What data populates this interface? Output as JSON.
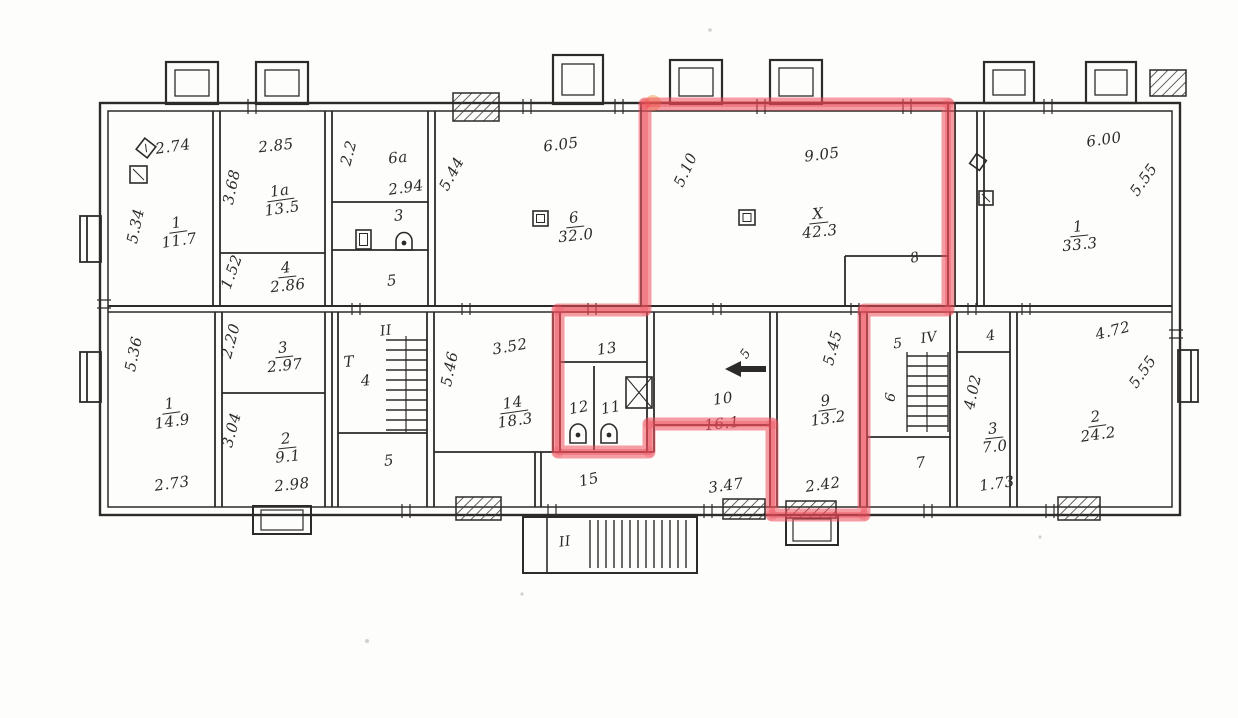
{
  "scan": {
    "paper_color": "#fdfdfc",
    "ink_color": "#2d2b2a",
    "marker_color": "#ee4e5a",
    "icon_legend": [
      "flue-icon",
      "toilet-icon",
      "sink-icon",
      "vent-shaft-icon",
      "direction-arrow-icon",
      "stairs-icon",
      "chimney-icon",
      "hatched-shaft-icon"
    ],
    "highlight": {
      "points": "645,104 948,104 948,310 864,310 864,515 772,515 772,424 649,424 649,452 558,452 558,310 645,310 645,104"
    },
    "labels": [
      {
        "name": "dim-room1-top",
        "kind": "dim",
        "text": "2.74",
        "x": 173,
        "y": 147,
        "rot": -8
      },
      {
        "name": "dim-room1-left",
        "kind": "dim",
        "text": "5.34",
        "x": 136,
        "y": 226,
        "rot": -78
      },
      {
        "name": "room1-upper",
        "kind": "frac",
        "num": "1",
        "den": "11.7",
        "x": 178,
        "y": 232,
        "rot": -8
      },
      {
        "name": "dim-room1a-top",
        "kind": "dim",
        "text": "2.85",
        "x": 276,
        "y": 146,
        "rot": -6
      },
      {
        "name": "dim-room1a-left",
        "kind": "dim",
        "text": "3.68",
        "x": 232,
        "y": 187,
        "rot": -78
      },
      {
        "name": "room1a",
        "kind": "frac",
        "num": "1а",
        "den": "13.5",
        "x": 281,
        "y": 200,
        "rot": -8
      },
      {
        "name": "dim-room4-left",
        "kind": "dim",
        "text": "1.52",
        "x": 232,
        "y": 272,
        "rot": -70
      },
      {
        "name": "room4",
        "kind": "frac",
        "num": "4",
        "den": "2.86",
        "x": 287,
        "y": 277,
        "rot": -6
      },
      {
        "name": "dim-room6a-left",
        "kind": "dim",
        "text": "2.2",
        "x": 349,
        "y": 153,
        "rot": -75
      },
      {
        "name": "room6a",
        "kind": "txt",
        "text": "6а",
        "x": 398,
        "y": 158,
        "rot": -6
      },
      {
        "name": "dim-room6a",
        "kind": "dim",
        "text": "2.94",
        "x": 406,
        "y": 188,
        "rot": -8
      },
      {
        "name": "room3-upper",
        "kind": "txt",
        "text": "3",
        "x": 399,
        "y": 216,
        "rot": -5
      },
      {
        "name": "room5-upper",
        "kind": "txt",
        "text": "5",
        "x": 392,
        "y": 281,
        "rot": -5
      },
      {
        "name": "dim-room6-top",
        "kind": "dim",
        "text": "6.05",
        "x": 561,
        "y": 145,
        "rot": -7
      },
      {
        "name": "dim-room6-left",
        "kind": "dim",
        "text": "5.44",
        "x": 452,
        "y": 174,
        "rot": -62
      },
      {
        "name": "room6",
        "kind": "frac",
        "num": "6",
        "den": "32.0",
        "x": 575,
        "y": 227,
        "rot": -6
      },
      {
        "name": "dim-roomx-top",
        "kind": "dim",
        "text": "9.05",
        "x": 822,
        "y": 155,
        "rot": -7
      },
      {
        "name": "dim-roomx-left",
        "kind": "dim",
        "text": "5.10",
        "x": 686,
        "y": 170,
        "rot": -65
      },
      {
        "name": "roomx",
        "kind": "frac",
        "num": "Х",
        "den": "42.3",
        "x": 819,
        "y": 223,
        "rot": -6
      },
      {
        "name": "room8",
        "kind": "txt",
        "text": "8",
        "x": 915,
        "y": 258,
        "rot": -12,
        "size": 14
      },
      {
        "name": "dim-room1r-top",
        "kind": "dim",
        "text": "6.00",
        "x": 1104,
        "y": 140,
        "rot": -8
      },
      {
        "name": "dim-room1r-right",
        "kind": "dim",
        "text": "5.55",
        "x": 1144,
        "y": 180,
        "rot": -55
      },
      {
        "name": "room1-right",
        "kind": "frac",
        "num": "1",
        "den": "33.3",
        "x": 1079,
        "y": 236,
        "rot": -6
      },
      {
        "name": "dim-room1b-left",
        "kind": "dim",
        "text": "5.36",
        "x": 134,
        "y": 354,
        "rot": -78
      },
      {
        "name": "room1-lower",
        "kind": "frac",
        "num": "1",
        "den": "14.9",
        "x": 171,
        "y": 413,
        "rot": -8
      },
      {
        "name": "dim-room1b-bottom",
        "kind": "dim",
        "text": "2.73",
        "x": 172,
        "y": 484,
        "rot": -8
      },
      {
        "name": "dim-room3b-left",
        "kind": "dim",
        "text": "2.20",
        "x": 231,
        "y": 341,
        "rot": -75
      },
      {
        "name": "room3-lower",
        "kind": "frac",
        "num": "3",
        "den": "2.97",
        "x": 284,
        "y": 357,
        "rot": -6
      },
      {
        "name": "dim-room2b-left",
        "kind": "dim",
        "text": "3.04",
        "x": 232,
        "y": 430,
        "rot": -75
      },
      {
        "name": "room2-lower",
        "kind": "frac",
        "num": "2",
        "den": "9.1",
        "x": 287,
        "y": 448,
        "rot": -6
      },
      {
        "name": "dim-room2b-bottom",
        "kind": "dim",
        "text": "2.98",
        "x": 292,
        "y": 485,
        "rot": -6
      },
      {
        "name": "stair-left-letter",
        "kind": "txt",
        "text": "Т",
        "x": 349,
        "y": 362,
        "rot": -5
      },
      {
        "name": "stair-left-number",
        "kind": "txt",
        "text": "4",
        "x": 366,
        "y": 381,
        "rot": -5
      },
      {
        "name": "stairwell-2-upper",
        "kind": "txt",
        "text": "II",
        "x": 386,
        "y": 331,
        "rot": -8,
        "size": 14
      },
      {
        "name": "room5-lower",
        "kind": "txt",
        "text": "5",
        "x": 389,
        "y": 461,
        "rot": -5
      },
      {
        "name": "dim-room14-left",
        "kind": "dim",
        "text": "5.46",
        "x": 450,
        "y": 369,
        "rot": -78
      },
      {
        "name": "dim-room14-top",
        "kind": "dim",
        "text": "3.52",
        "x": 510,
        "y": 347,
        "rot": -10
      },
      {
        "name": "room14",
        "kind": "frac",
        "num": "14",
        "den": "18.3",
        "x": 514,
        "y": 412,
        "rot": -8
      },
      {
        "name": "room13",
        "kind": "txt",
        "text": "13",
        "x": 607,
        "y": 349,
        "rot": -8
      },
      {
        "name": "room12",
        "kind": "txt",
        "text": "12",
        "x": 579,
        "y": 408,
        "rot": -10
      },
      {
        "name": "room11",
        "kind": "txt",
        "text": "11",
        "x": 611,
        "y": 408,
        "rot": -10
      },
      {
        "name": "room15",
        "kind": "txt",
        "text": "15",
        "x": 589,
        "y": 480,
        "rot": -12
      },
      {
        "name": "room10",
        "kind": "txt",
        "text": "10",
        "x": 723,
        "y": 399,
        "rot": -8
      },
      {
        "name": "dim-corridor10",
        "kind": "dim",
        "text": "16.1",
        "x": 722,
        "y": 424,
        "rot": -6,
        "cls": "under-red"
      },
      {
        "name": "dim-room15-bottom",
        "kind": "dim",
        "text": "3.47",
        "x": 726,
        "y": 486,
        "rot": -8
      },
      {
        "name": "dim-door-width",
        "kind": "txt",
        "text": "5",
        "x": 746,
        "y": 354,
        "rot": -55,
        "size": 13
      },
      {
        "name": "dim-room9-left",
        "kind": "dim",
        "text": "5.45",
        "x": 833,
        "y": 348,
        "rot": -75
      },
      {
        "name": "room9",
        "kind": "frac",
        "num": "9",
        "den": "13.2",
        "x": 827,
        "y": 410,
        "rot": -8
      },
      {
        "name": "dim-room9-bottom",
        "kind": "dim",
        "text": "2.42",
        "x": 823,
        "y": 485,
        "rot": -8
      },
      {
        "name": "stairwell-4",
        "kind": "txt",
        "text": "IV",
        "x": 929,
        "y": 338,
        "rot": -8,
        "size": 14
      },
      {
        "name": "room5-right",
        "kind": "txt",
        "text": "5",
        "x": 898,
        "y": 344,
        "rot": -5,
        "size": 14
      },
      {
        "name": "room6-right",
        "kind": "txt",
        "text": "6",
        "x": 891,
        "y": 397,
        "rot": -80,
        "size": 14
      },
      {
        "name": "room7",
        "kind": "txt",
        "text": "7",
        "x": 921,
        "y": 463,
        "rot": -8
      },
      {
        "name": "room4-right",
        "kind": "txt",
        "text": "4",
        "x": 991,
        "y": 336,
        "rot": -8,
        "size": 14
      },
      {
        "name": "dim-room3r-left",
        "kind": "dim",
        "text": "4.02",
        "x": 973,
        "y": 392,
        "rot": -78
      },
      {
        "name": "room3-right",
        "kind": "frac",
        "num": "3",
        "den": "7.0",
        "x": 994,
        "y": 438,
        "rot": -6
      },
      {
        "name": "dim-room3r-bottom",
        "kind": "dim",
        "text": "1.73",
        "x": 997,
        "y": 484,
        "rot": -8
      },
      {
        "name": "dim-room2r-top",
        "kind": "dim",
        "text": "4.72",
        "x": 1113,
        "y": 331,
        "rot": -14
      },
      {
        "name": "dim-room2r-right",
        "kind": "dim",
        "text": "5.55",
        "x": 1143,
        "y": 372,
        "rot": -55
      },
      {
        "name": "room2-right",
        "kind": "frac",
        "num": "2",
        "den": "24.2",
        "x": 1097,
        "y": 426,
        "rot": -8
      },
      {
        "name": "stair-porch",
        "kind": "txt",
        "text": "II",
        "x": 565,
        "y": 542,
        "rot": -8,
        "size": 14
      }
    ]
  }
}
